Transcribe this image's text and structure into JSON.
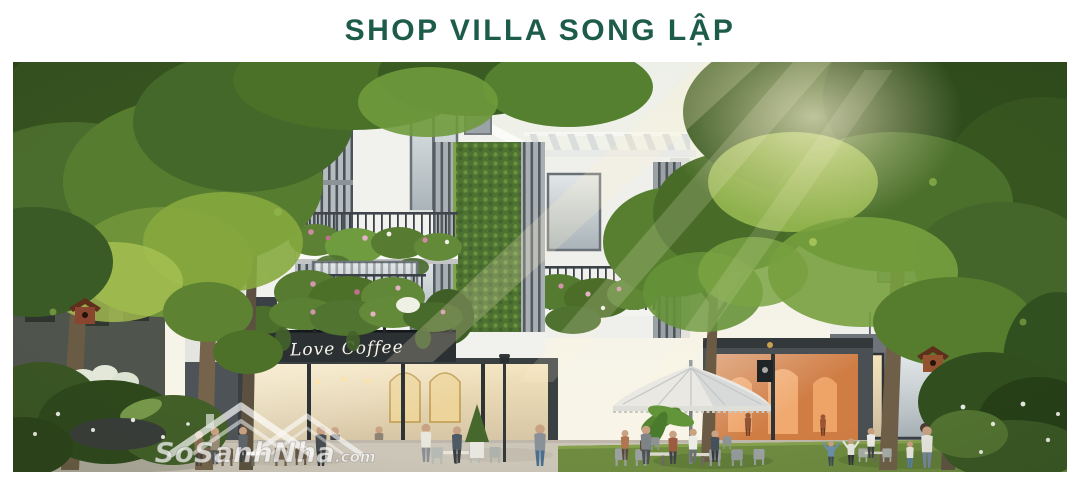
{
  "header": {
    "title": "SHOP VILLA SONG LẬP"
  },
  "photo": {
    "cafe_sign_text": "Love Coffee",
    "watermark": {
      "main": "SoSanhNha",
      "suffix": ".com"
    }
  },
  "colors": {
    "title_green": "#1d5c4b",
    "sign_band": "#2b3033",
    "sign_text": "#f7f3e8",
    "foliage_dark": "#35521f",
    "foliage_mid": "#4f7530",
    "foliage_light": "#86a83e",
    "building_white": "#f1f1ee",
    "stone_dark": "#4b5054",
    "pavement": "#ccc6b9",
    "lawn": "#6f8b40",
    "umbrella": "#e9e8e3",
    "watermark_white": "#ffffff"
  }
}
